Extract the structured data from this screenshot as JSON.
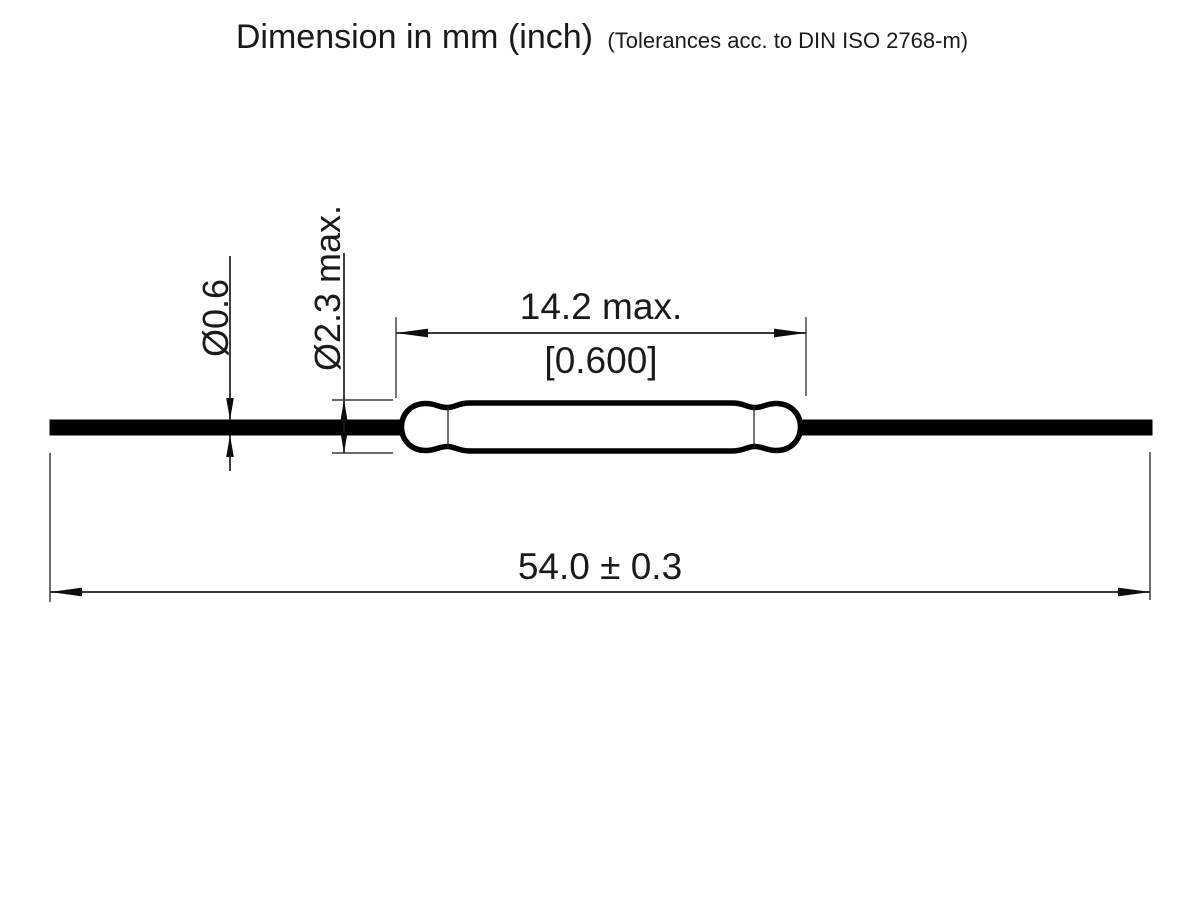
{
  "title": {
    "main": "Dimension in mm (inch)",
    "note": "(Tolerances acc. to DIN ISO 2768-m)"
  },
  "drawing": {
    "component": "reed-switch-outline",
    "units": "mm (inch)",
    "tolerance_standard": "DIN ISO 2768-m"
  },
  "dimensions": {
    "lead_diameter": {
      "label": "Ø0.6",
      "value_mm": 0.6
    },
    "glass_diameter": {
      "label": "Ø2.3 max.",
      "value_mm": 2.3,
      "qualifier": "max."
    },
    "glass_length": {
      "label_mm": "14.2 max.",
      "label_inch": "[0.600]",
      "value_mm": 14.2,
      "value_inch": 0.6,
      "qualifier": "max."
    },
    "total_length": {
      "label": "54.0 ± 0.3",
      "value_mm": 54.0,
      "tolerance_mm": 0.3
    }
  },
  "colors": {
    "background": "#ffffff",
    "drawing_line": "#000000",
    "thin_line": "#3a3a3a",
    "extension_line_gray": "#6e6e6e"
  }
}
